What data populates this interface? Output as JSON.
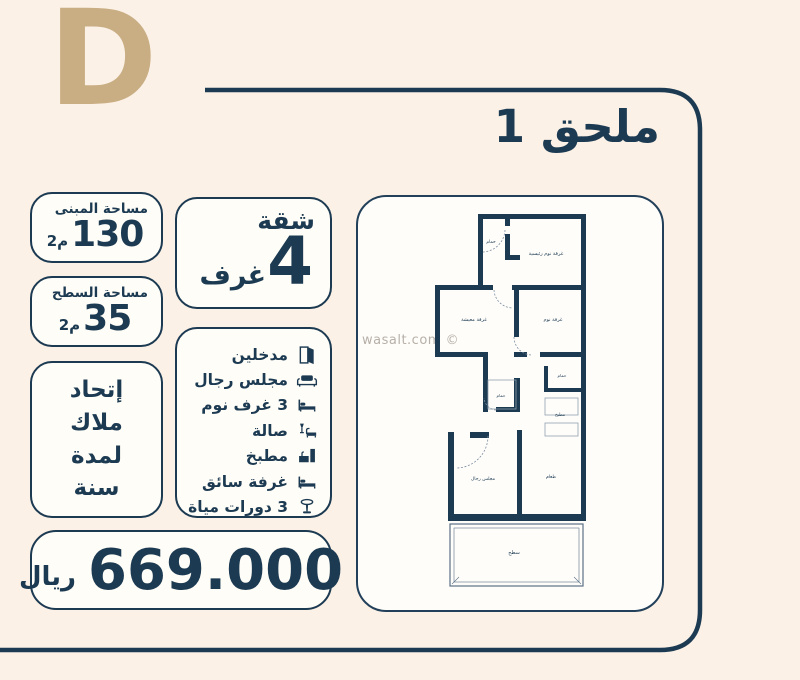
{
  "colors": {
    "background": "#fbf1e6",
    "navy": "#1c3a52",
    "beige": "#c9ad83",
    "box_fill": "#fffdf7",
    "watermark_gray": "#b7b0a8"
  },
  "header": {
    "letter": "D",
    "title": "ملحق 1"
  },
  "stats": [
    {
      "label": "مساحة المبنى",
      "value": "130",
      "unit": "م2"
    },
    {
      "label": "مساحة السطح",
      "value": "35",
      "unit": "م2"
    }
  ],
  "ownership": {
    "lines": [
      "إتحاد",
      "ملاك",
      "لمدة",
      "سنة"
    ]
  },
  "apartment": {
    "type_label": "شقة",
    "rooms_count": "4",
    "rooms_label": "غرف"
  },
  "amenities": [
    {
      "icon": "door-icon",
      "label": "مدخلين"
    },
    {
      "icon": "sofa-icon",
      "label": "مجلس رجال"
    },
    {
      "icon": "bed-icon",
      "label": "3 غرف نوم"
    },
    {
      "icon": "lounge-icon",
      "label": "صالة"
    },
    {
      "icon": "kitchen-icon",
      "label": "مطبخ"
    },
    {
      "icon": "bed-icon",
      "label": "غرفة سائق"
    },
    {
      "icon": "basin-icon",
      "label": "3 دورات مياة"
    }
  ],
  "price": {
    "amount": "669.000",
    "currency": "ريال"
  },
  "floor_plan": {
    "watermark": "wasalt.com ©",
    "rooms": [
      {
        "name": "master-bedroom",
        "label": "غرفة نوم رئيسية"
      },
      {
        "name": "bathroom-top",
        "label": "حمام"
      },
      {
        "name": "living-room",
        "label": "غرفة معيشة"
      },
      {
        "name": "bedroom",
        "label": "غرفة نوم"
      },
      {
        "name": "bathroom-middle",
        "label": "حمام"
      },
      {
        "name": "bathroom-left",
        "label": "حمام"
      },
      {
        "name": "kitchen",
        "label": "مطبخ"
      },
      {
        "name": "mens-majlis",
        "label": "مجلس رجال"
      },
      {
        "name": "dining",
        "label": "طعام"
      },
      {
        "name": "terrace",
        "label": "سطح"
      }
    ]
  }
}
